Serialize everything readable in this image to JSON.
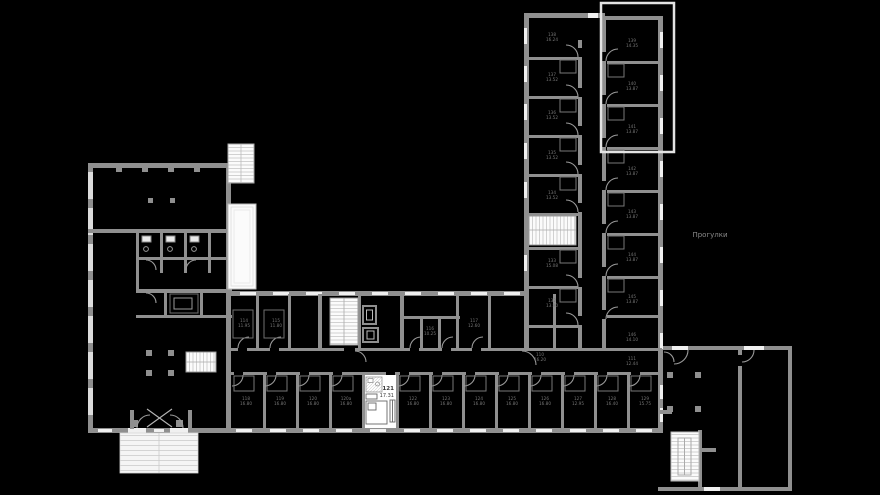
{
  "canvas": {
    "width": 880,
    "height": 495,
    "background": "#000000"
  },
  "colors": {
    "wall": "#8f8f8f",
    "wall_light": "#dcdcdc",
    "window": "#f0f0f0",
    "stair_fill": "#fbfbfb",
    "stair_line": "#c0c0c0",
    "door_arc": "#9a9a9a",
    "furniture": "#6f6f6f",
    "highlight_room": "#ffffff",
    "micro_label": "#767676",
    "selected_label": "#3a3a3a",
    "terrace_outline": "#e3e3e3"
  },
  "selected_room": {
    "number": "121",
    "area": "17.31"
  },
  "annotations": {
    "area_label": "Прогулки"
  },
  "room_labels": [
    {
      "x": 552,
      "y": 36,
      "no": "138",
      "area": "16.24"
    },
    {
      "x": 552,
      "y": 76,
      "no": "137",
      "area": "13.52"
    },
    {
      "x": 552,
      "y": 114,
      "no": "136",
      "area": "13.52"
    },
    {
      "x": 552,
      "y": 154,
      "no": "135",
      "area": "13.52"
    },
    {
      "x": 552,
      "y": 194,
      "no": "134",
      "area": "13.52"
    },
    {
      "x": 552,
      "y": 262,
      "no": "133",
      "area": "15.08"
    },
    {
      "x": 552,
      "y": 302,
      "no": "132",
      "area": "13.90"
    },
    {
      "x": 632,
      "y": 42,
      "no": "139",
      "area": "14.35"
    },
    {
      "x": 632,
      "y": 85,
      "no": "140",
      "area": "13.87"
    },
    {
      "x": 632,
      "y": 128,
      "no": "141",
      "area": "13.87"
    },
    {
      "x": 632,
      "y": 170,
      "no": "142",
      "area": "13.87"
    },
    {
      "x": 632,
      "y": 213,
      "no": "143",
      "area": "13.87"
    },
    {
      "x": 632,
      "y": 256,
      "no": "144",
      "area": "13.87"
    },
    {
      "x": 632,
      "y": 298,
      "no": "145",
      "area": "13.87"
    },
    {
      "x": 632,
      "y": 336,
      "no": "146",
      "area": "14.10"
    },
    {
      "x": 540,
      "y": 356,
      "no": "110",
      "area": "16.20"
    },
    {
      "x": 632,
      "y": 360,
      "no": "111",
      "area": "12.44"
    },
    {
      "x": 244,
      "y": 322,
      "no": "114",
      "area": "11.95"
    },
    {
      "x": 276,
      "y": 322,
      "no": "115",
      "area": "11.80"
    },
    {
      "x": 430,
      "y": 330,
      "no": "116",
      "area": "10.25"
    },
    {
      "x": 474,
      "y": 322,
      "no": "117",
      "area": "12.60"
    },
    {
      "x": 246,
      "y": 400,
      "no": "118",
      "area": "16.80"
    },
    {
      "x": 280,
      "y": 400,
      "no": "119",
      "area": "16.80"
    },
    {
      "x": 313,
      "y": 400,
      "no": "120",
      "area": "16.80"
    },
    {
      "x": 346,
      "y": 400,
      "no": "120а",
      "area": "16.80"
    },
    {
      "x": 413,
      "y": 400,
      "no": "122",
      "area": "16.80"
    },
    {
      "x": 446,
      "y": 400,
      "no": "123",
      "area": "16.80"
    },
    {
      "x": 479,
      "y": 400,
      "no": "124",
      "area": "16.80"
    },
    {
      "x": 512,
      "y": 400,
      "no": "125",
      "area": "16.80"
    },
    {
      "x": 545,
      "y": 400,
      "no": "126",
      "area": "16.80"
    },
    {
      "x": 578,
      "y": 400,
      "no": "127",
      "area": "12.95"
    },
    {
      "x": 612,
      "y": 400,
      "no": "128",
      "area": "16.40"
    },
    {
      "x": 645,
      "y": 400,
      "no": "129",
      "area": "15.75"
    }
  ]
}
